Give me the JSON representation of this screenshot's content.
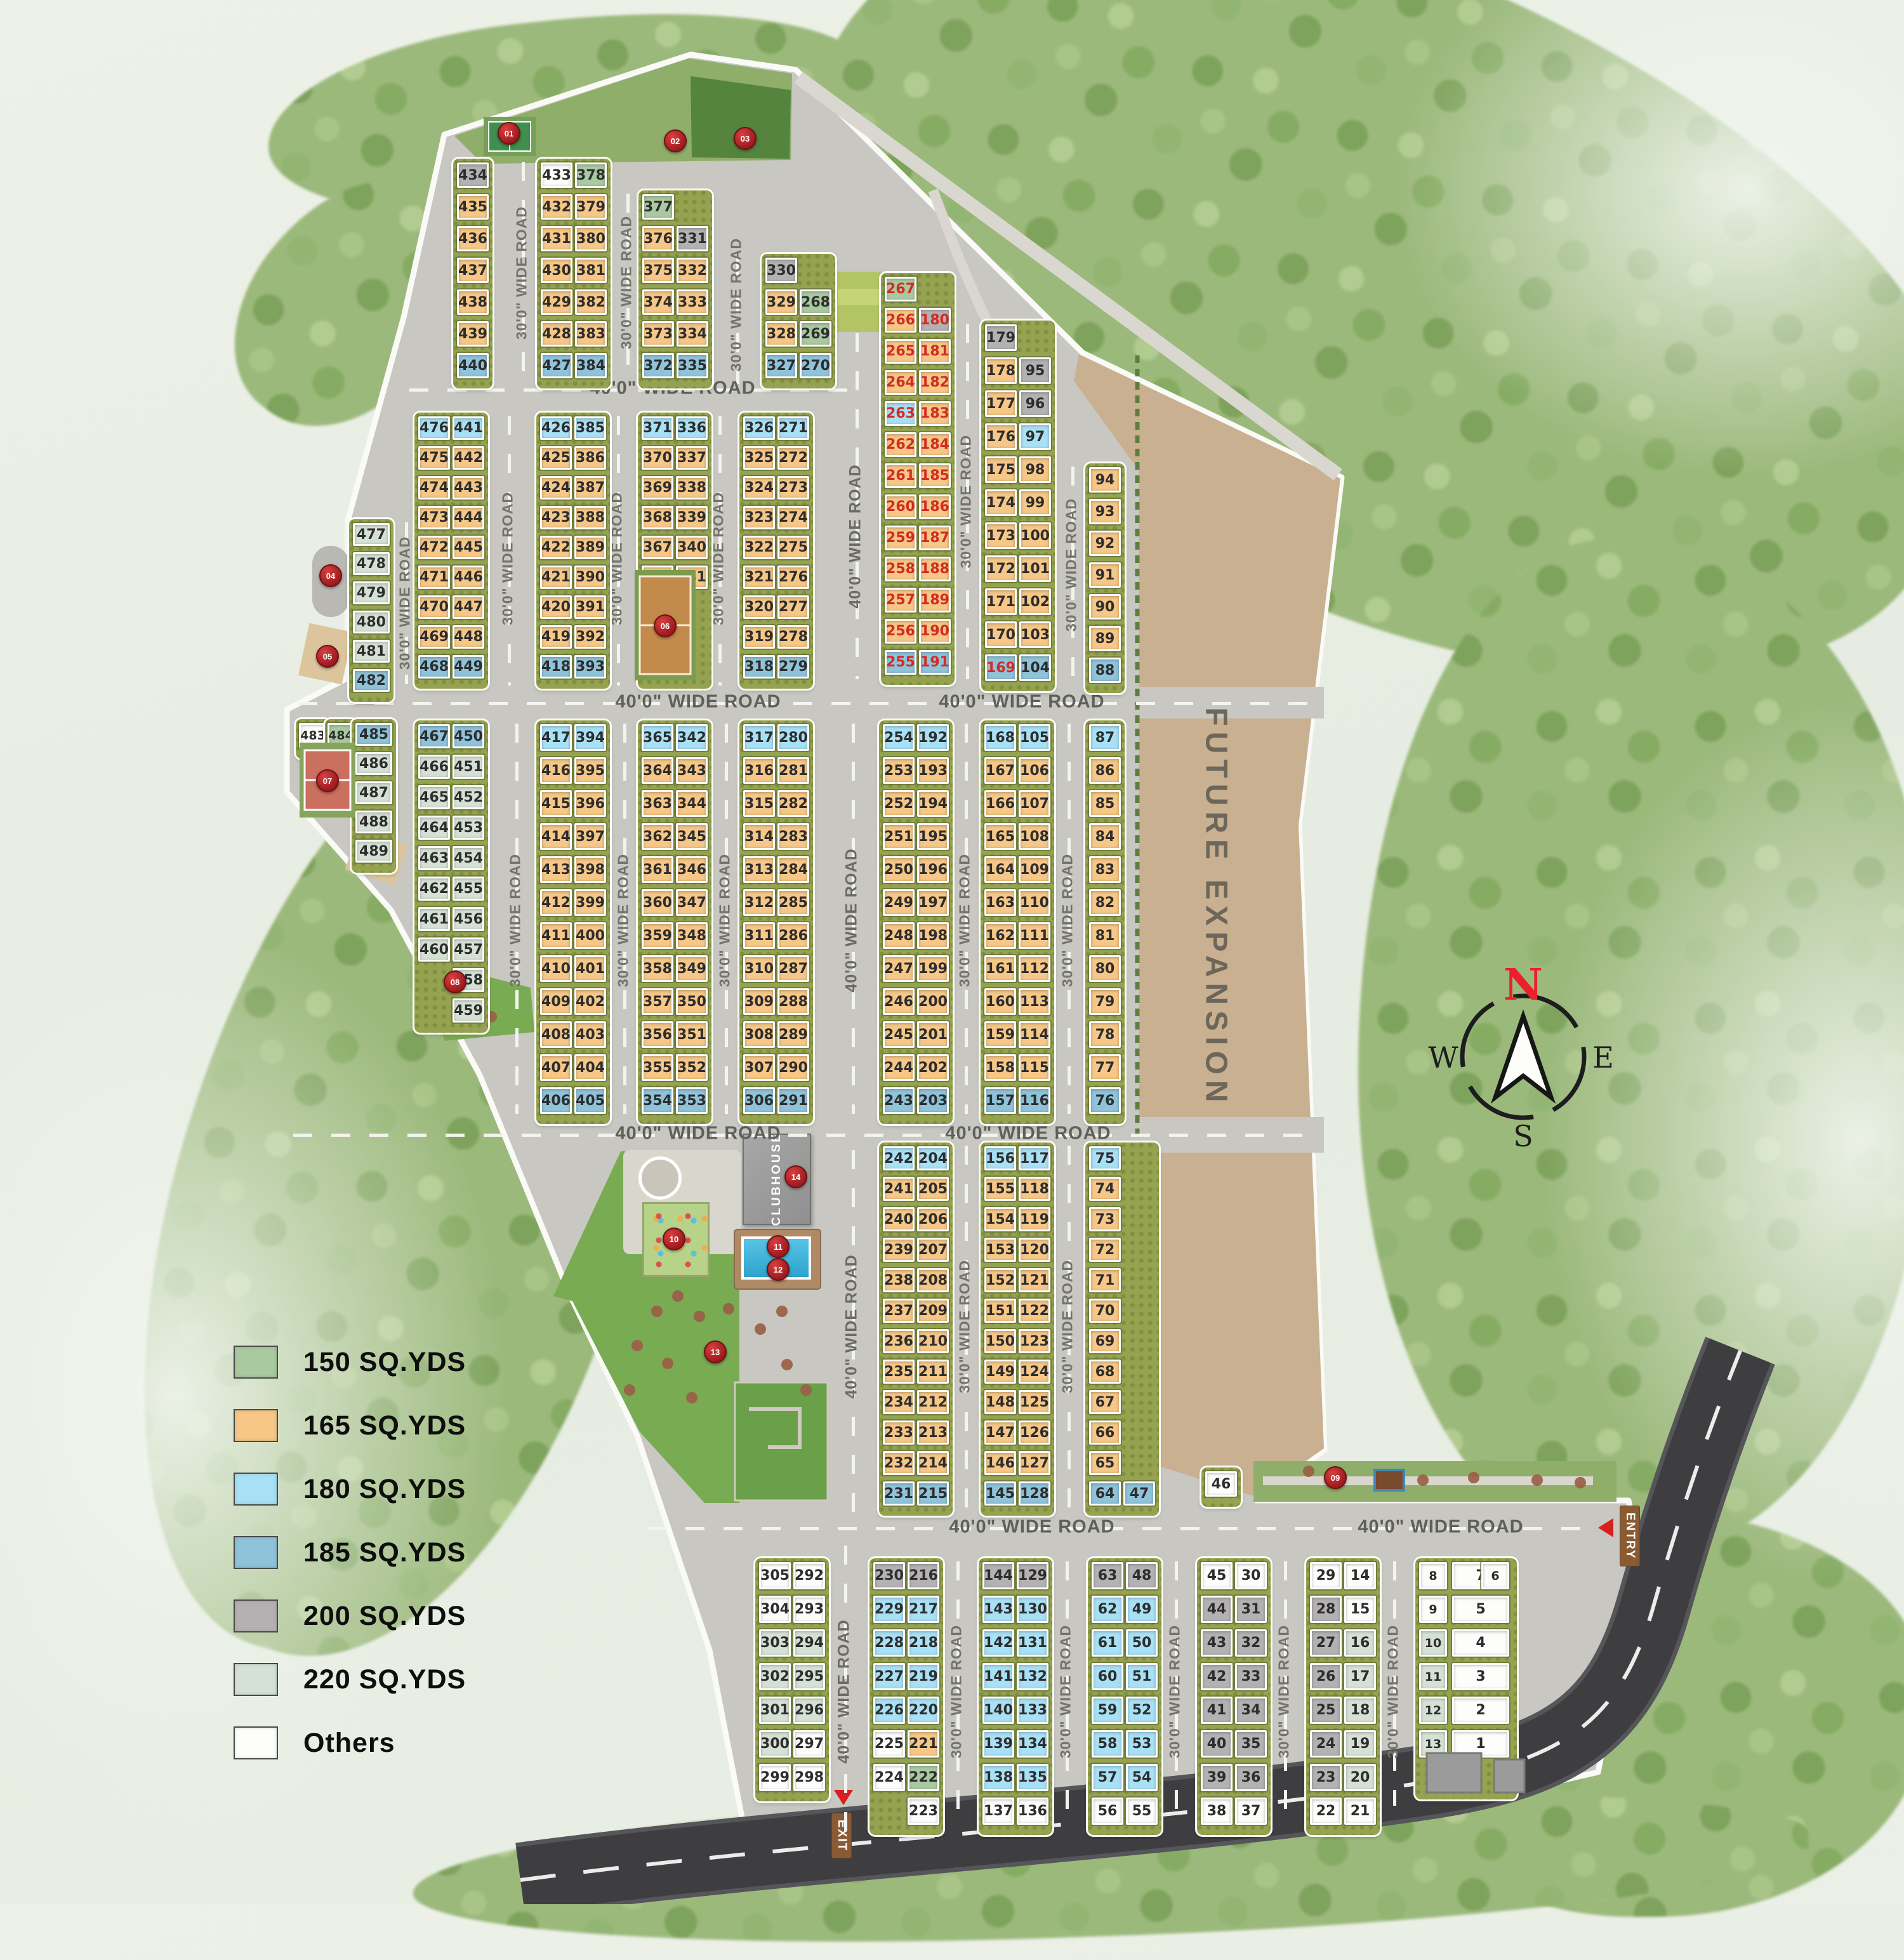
{
  "legend": {
    "items": [
      {
        "key": "g",
        "label": "150 SQ.YDS"
      },
      {
        "key": "o",
        "label": "165 SQ.YDS"
      },
      {
        "key": "l",
        "label": "180 SQ.YDS"
      },
      {
        "key": "b",
        "label": "185 SQ.YDS"
      },
      {
        "key": "q",
        "label": "200 SQ.YDS"
      },
      {
        "key": "s",
        "label": "220 SQ.YDS"
      },
      {
        "key": "w",
        "label": "Others"
      }
    ]
  },
  "colors": {
    "g": "#a9c9a0",
    "o": "#f6c787",
    "l": "#a8e0f5",
    "b": "#8fc3da",
    "q": "#b4b1b2",
    "s": "#d6e1d5",
    "w": "#fdfdfb",
    "sold": "#d22b23"
  },
  "labels": {
    "road30": "30'0\" WIDE ROAD",
    "road40": "40'0\" WIDE ROAD",
    "future": "FUTURE EXPANSION",
    "clubhouse": "CLUBHOUSE",
    "exit": "EXIT",
    "entry": "ENTRY"
  },
  "compass": {
    "n": "N",
    "e": "E",
    "s": "S",
    "w": "W"
  },
  "markers": [
    "01",
    "02",
    "03",
    "04",
    "05",
    "06",
    "07",
    "08",
    "09",
    "10",
    "11",
    "12",
    "13",
    "14"
  ],
  "blocks": [
    {
      "id": "bA",
      "cols": [
        [
          "434:q",
          "435",
          "436",
          "437",
          "438",
          "439",
          "440:b"
        ]
      ]
    },
    {
      "id": "bB",
      "cols": [
        [
          "433:w",
          "432",
          "431",
          "430",
          "429",
          "428",
          "427:b"
        ],
        [
          "378:g",
          "379",
          "380",
          "381",
          "382",
          "383",
          "384:b"
        ]
      ]
    },
    {
      "id": "bC",
      "cols": [
        [
          "377:g",
          "376",
          "375",
          "374",
          "373",
          "372:b"
        ],
        [
          null,
          "331:q",
          "332",
          "333",
          "334",
          "335:b"
        ]
      ]
    },
    {
      "id": "bD",
      "cols": [
        [
          "330:q",
          "329",
          "328",
          "327:b"
        ],
        [
          null,
          "268:g",
          "269:g",
          "270:b"
        ]
      ]
    },
    {
      "id": "bE",
      "cols": [
        [
          "267:g:r",
          "266:o:r",
          "265:o:r",
          "264:o:r",
          "263:l:r",
          "262:o:r",
          "261:o:r",
          "260:o:r",
          "259:o:r",
          "258:o:r",
          "257:o:r",
          "256:o:r",
          "255:b:r"
        ],
        [
          null,
          "180:q:r",
          "181:o:r",
          "182:o:r",
          "183:o:r",
          "184:o:r",
          "185:o:r",
          "186:o:r",
          "187:o:r",
          "188:o:r",
          "189:o:r",
          "190:o:r",
          "191:b:r"
        ]
      ]
    },
    {
      "id": "bF",
      "cols": [
        [
          "179:q",
          "178",
          "177",
          "176",
          "175",
          "174",
          "173",
          "172",
          "171",
          "170",
          "169:b:r"
        ],
        [
          null,
          "95:q",
          "96:q",
          "97:l",
          "98",
          "99",
          "100",
          "101",
          "102",
          "103",
          "104:b"
        ]
      ]
    },
    {
      "id": "bG",
      "cols": [
        [
          "94",
          "93",
          "92",
          "91",
          "90",
          "89",
          "88:b"
        ]
      ]
    },
    {
      "id": "bW477",
      "cols": [
        [
          "477:s",
          "478:s",
          "479:s",
          "480:s",
          "481:s",
          "482:b"
        ]
      ]
    },
    {
      "id": "b476",
      "cols": [
        [
          "476:l",
          "475",
          "474",
          "473",
          "472",
          "471",
          "470",
          "469",
          "468:b"
        ],
        [
          "441:l",
          "442",
          "443",
          "444",
          "445",
          "446",
          "447",
          "448",
          "449:b"
        ]
      ]
    },
    {
      "id": "b426",
      "cols": [
        [
          "426:l",
          "425",
          "424",
          "423",
          "422",
          "421",
          "420",
          "419",
          "418:b"
        ],
        [
          "385:l",
          "386",
          "387",
          "388",
          "389",
          "390",
          "391",
          "392",
          "393:b"
        ]
      ]
    },
    {
      "id": "b371",
      "cols": [
        [
          "371:l",
          "370",
          "369",
          "368",
          "367",
          "366"
        ],
        [
          "336:l",
          "337",
          "338",
          "339",
          "340",
          "341"
        ]
      ]
    },
    {
      "id": "b326",
      "cols": [
        [
          "326:l",
          "325",
          "324",
          "323",
          "322",
          "321",
          "320",
          "319",
          "318:b"
        ],
        [
          "271:l",
          "272",
          "273",
          "274",
          "275",
          "276",
          "277",
          "278",
          "279:b"
        ]
      ]
    },
    {
      "id": "b483",
      "cols": [
        [
          "483:w"
        ]
      ]
    },
    {
      "id": "b484",
      "cols": [
        [
          "484:g"
        ]
      ]
    },
    {
      "id": "bW485",
      "cols": [
        [
          "485:b",
          "486:s",
          "487:s",
          "488:s",
          "489:s"
        ]
      ]
    },
    {
      "id": "b467",
      "cols": [
        [
          "467:b",
          "466:s",
          "465:s",
          "464:s",
          "463:s",
          "462:s",
          "461:s",
          "460:s"
        ],
        [
          "450:b",
          "451:s",
          "452:s",
          "453:s",
          "454:s",
          "455:s",
          "456:s",
          "457:s",
          "458:s",
          "459:s"
        ]
      ]
    },
    {
      "id": "b417",
      "cols": [
        [
          "417:l",
          "416",
          "415",
          "414",
          "413",
          "412",
          "411",
          "410",
          "409",
          "408",
          "407",
          "406:b"
        ],
        [
          "394:l",
          "395",
          "396",
          "397",
          "398",
          "399",
          "400",
          "401",
          "402",
          "403",
          "404",
          "405:b"
        ]
      ]
    },
    {
      "id": "b365",
      "cols": [
        [
          "365:l",
          "364",
          "363",
          "362",
          "361",
          "360",
          "359",
          "358",
          "357",
          "356",
          "355",
          "354:b"
        ],
        [
          "342:l",
          "343",
          "344",
          "345",
          "346",
          "347",
          "348",
          "349",
          "350",
          "351",
          "352",
          "353:b"
        ]
      ]
    },
    {
      "id": "b317",
      "cols": [
        [
          "317:l",
          "316",
          "315",
          "314",
          "313",
          "312",
          "311",
          "310",
          "309",
          "308",
          "307",
          "306:b"
        ],
        [
          "280:l",
          "281",
          "282",
          "283",
          "284",
          "285",
          "286",
          "287",
          "288",
          "289",
          "290",
          "291:b"
        ]
      ]
    },
    {
      "id": "b254",
      "cols": [
        [
          "254:l",
          "253",
          "252",
          "251",
          "250",
          "249",
          "248",
          "247",
          "246",
          "245",
          "244",
          "243:b"
        ],
        [
          "192:l",
          "193",
          "194",
          "195",
          "196",
          "197",
          "198",
          "199",
          "200",
          "201",
          "202",
          "203:b"
        ]
      ]
    },
    {
      "id": "b168",
      "cols": [
        [
          "168:l",
          "167",
          "166",
          "165",
          "164",
          "163",
          "162",
          "161",
          "160",
          "159",
          "158",
          "157:b"
        ],
        [
          "105:l",
          "106",
          "107",
          "108",
          "109",
          "110",
          "111",
          "112",
          "113",
          "114",
          "115",
          "116:b"
        ]
      ]
    },
    {
      "id": "b87",
      "cols": [
        [
          "87:l",
          "86",
          "85",
          "84",
          "83",
          "82",
          "81",
          "80",
          "79",
          "78",
          "77",
          "76:b"
        ]
      ]
    },
    {
      "id": "b242",
      "cols": [
        [
          "242:l",
          "241",
          "240",
          "239",
          "238",
          "237",
          "236",
          "235",
          "234",
          "233",
          "232",
          "231:b"
        ],
        [
          "204:l",
          "205",
          "206",
          "207",
          "208",
          "209",
          "210",
          "211",
          "212",
          "213",
          "214",
          "215:b"
        ]
      ]
    },
    {
      "id": "b156",
      "cols": [
        [
          "156:l",
          "155",
          "154",
          "153",
          "152",
          "151",
          "150",
          "149",
          "148",
          "147",
          "146",
          "145:b"
        ],
        [
          "117:l",
          "118",
          "119",
          "120",
          "121",
          "122",
          "123",
          "124",
          "125",
          "126",
          "127",
          "128:b"
        ]
      ]
    },
    {
      "id": "b75",
      "cols": [
        [
          "75:l",
          "74",
          "73",
          "72",
          "71",
          "70",
          "69",
          "68",
          "67",
          "66",
          "65",
          "64:b"
        ],
        [
          null,
          null,
          null,
          null,
          null,
          null,
          null,
          null,
          null,
          null,
          null,
          "47:b"
        ]
      ]
    },
    {
      "id": "b46",
      "cols": [
        [
          "46:w"
        ]
      ]
    },
    {
      "id": "b305",
      "cols": [
        [
          "305:w",
          "304:w",
          "303:s",
          "302:s",
          "301:s",
          "300:s",
          "299:w"
        ],
        [
          "292:w",
          "293:w",
          "294:s",
          "295:s",
          "296:s",
          "297:w",
          "298:w"
        ]
      ]
    },
    {
      "id": "b230",
      "cols": [
        [
          "230:q",
          "229:l",
          "228:l",
          "227:l",
          "226:l",
          "225:w",
          "224:w"
        ],
        [
          "216:q",
          "217:l",
          "218:l",
          "219:l",
          "220:l",
          "221:o",
          "222:g",
          "223:w"
        ]
      ]
    },
    {
      "id": "b144",
      "cols": [
        [
          "144:q",
          "143:l",
          "142:l",
          "141:l",
          "140:l",
          "139:l",
          "138:l",
          "137:w"
        ],
        [
          "129:q",
          "130:l",
          "131:l",
          "132:l",
          "133:l",
          "134:l",
          "135:l",
          "136:w"
        ]
      ]
    },
    {
      "id": "b63",
      "cols": [
        [
          "63:q",
          "62:l",
          "61:l",
          "60:l",
          "59:l",
          "58:l",
          "57:l",
          "56:w"
        ],
        [
          "48:q",
          "49:l",
          "50:l",
          "51:l",
          "52:l",
          "53:l",
          "54:l",
          "55:w"
        ]
      ]
    },
    {
      "id": "b45",
      "cols": [
        [
          "45:w",
          "44:q",
          "43:q",
          "42:q",
          "41:q",
          "40:q",
          "39:q",
          "38:w"
        ],
        [
          "30:w",
          "31:q",
          "32:q",
          "33:q",
          "34:q",
          "35:q",
          "36:q",
          "37:w"
        ]
      ]
    },
    {
      "id": "b29",
      "cols": [
        [
          "29:w",
          "28:q",
          "27:q",
          "26:q",
          "25:q",
          "24:q",
          "23:q",
          "22:w"
        ],
        [
          "14:w",
          "15:w",
          "16:s",
          "17:s",
          "18:s",
          "19:s",
          "20:s",
          "21:w"
        ]
      ]
    },
    {
      "id": "b8",
      "cols": [
        [
          "8:w",
          "9:w",
          "10:s",
          "11:s",
          "12:s",
          "13:s"
        ],
        [
          "7:w",
          "5:w",
          "4:w",
          "3:w",
          "2:w",
          "1:w"
        ],
        [
          "6:w"
        ]
      ]
    }
  ]
}
